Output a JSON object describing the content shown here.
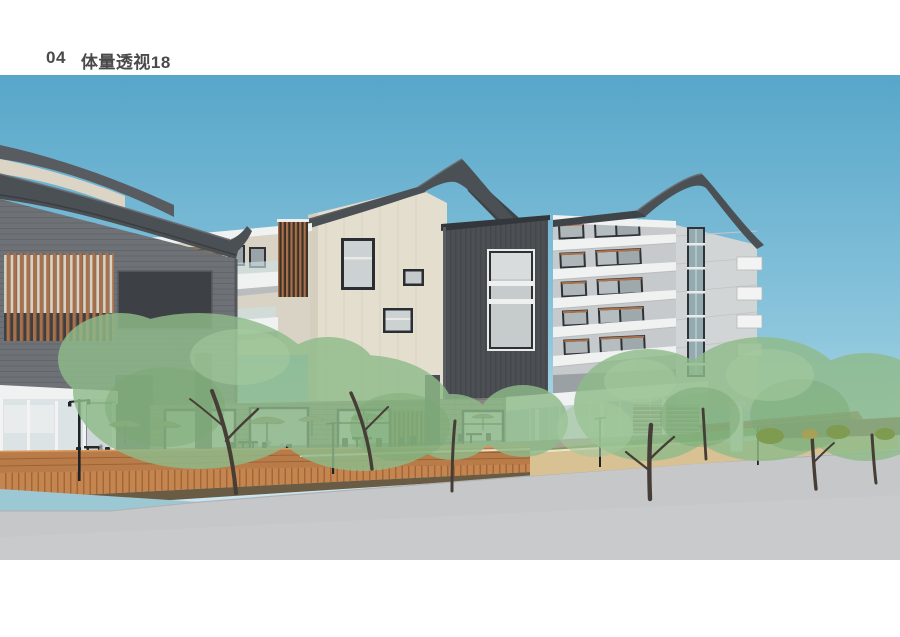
{
  "page": {
    "title_number": "04",
    "title_label": "体量透视18"
  },
  "palette": {
    "title-color": "#4a4a4a",
    "sky-top": "#57a6c9",
    "sky-mid": "#8ec7dd",
    "sky-low": "#c8e4ef",
    "roof-dark": "#4b5054",
    "roof-mid": "#5d6165",
    "cladding-dark": "#4c5054",
    "facade-gray": "#6e7276",
    "wall-beige": "#e4decf",
    "wall-light": "#c6cacc",
    "wall-lighter": "#d2d5d6",
    "white-trim": "#f0f1f1",
    "wood-accent": "#a9714b",
    "deck-wood": "#b97c49",
    "deck-face": "#c5854e",
    "road-gray": "#c6c7c9",
    "plaza-floor": "#a5a391",
    "grass-green": "#7d9c5c",
    "tree-green": "#8fbb8a",
    "water-blue": "#9cc8d4",
    "tan-wall": "#d8c193",
    "brown-wall": "#7a4936",
    "glass-tint": "#d3d9da",
    "people-gray": "#8f969b"
  }
}
